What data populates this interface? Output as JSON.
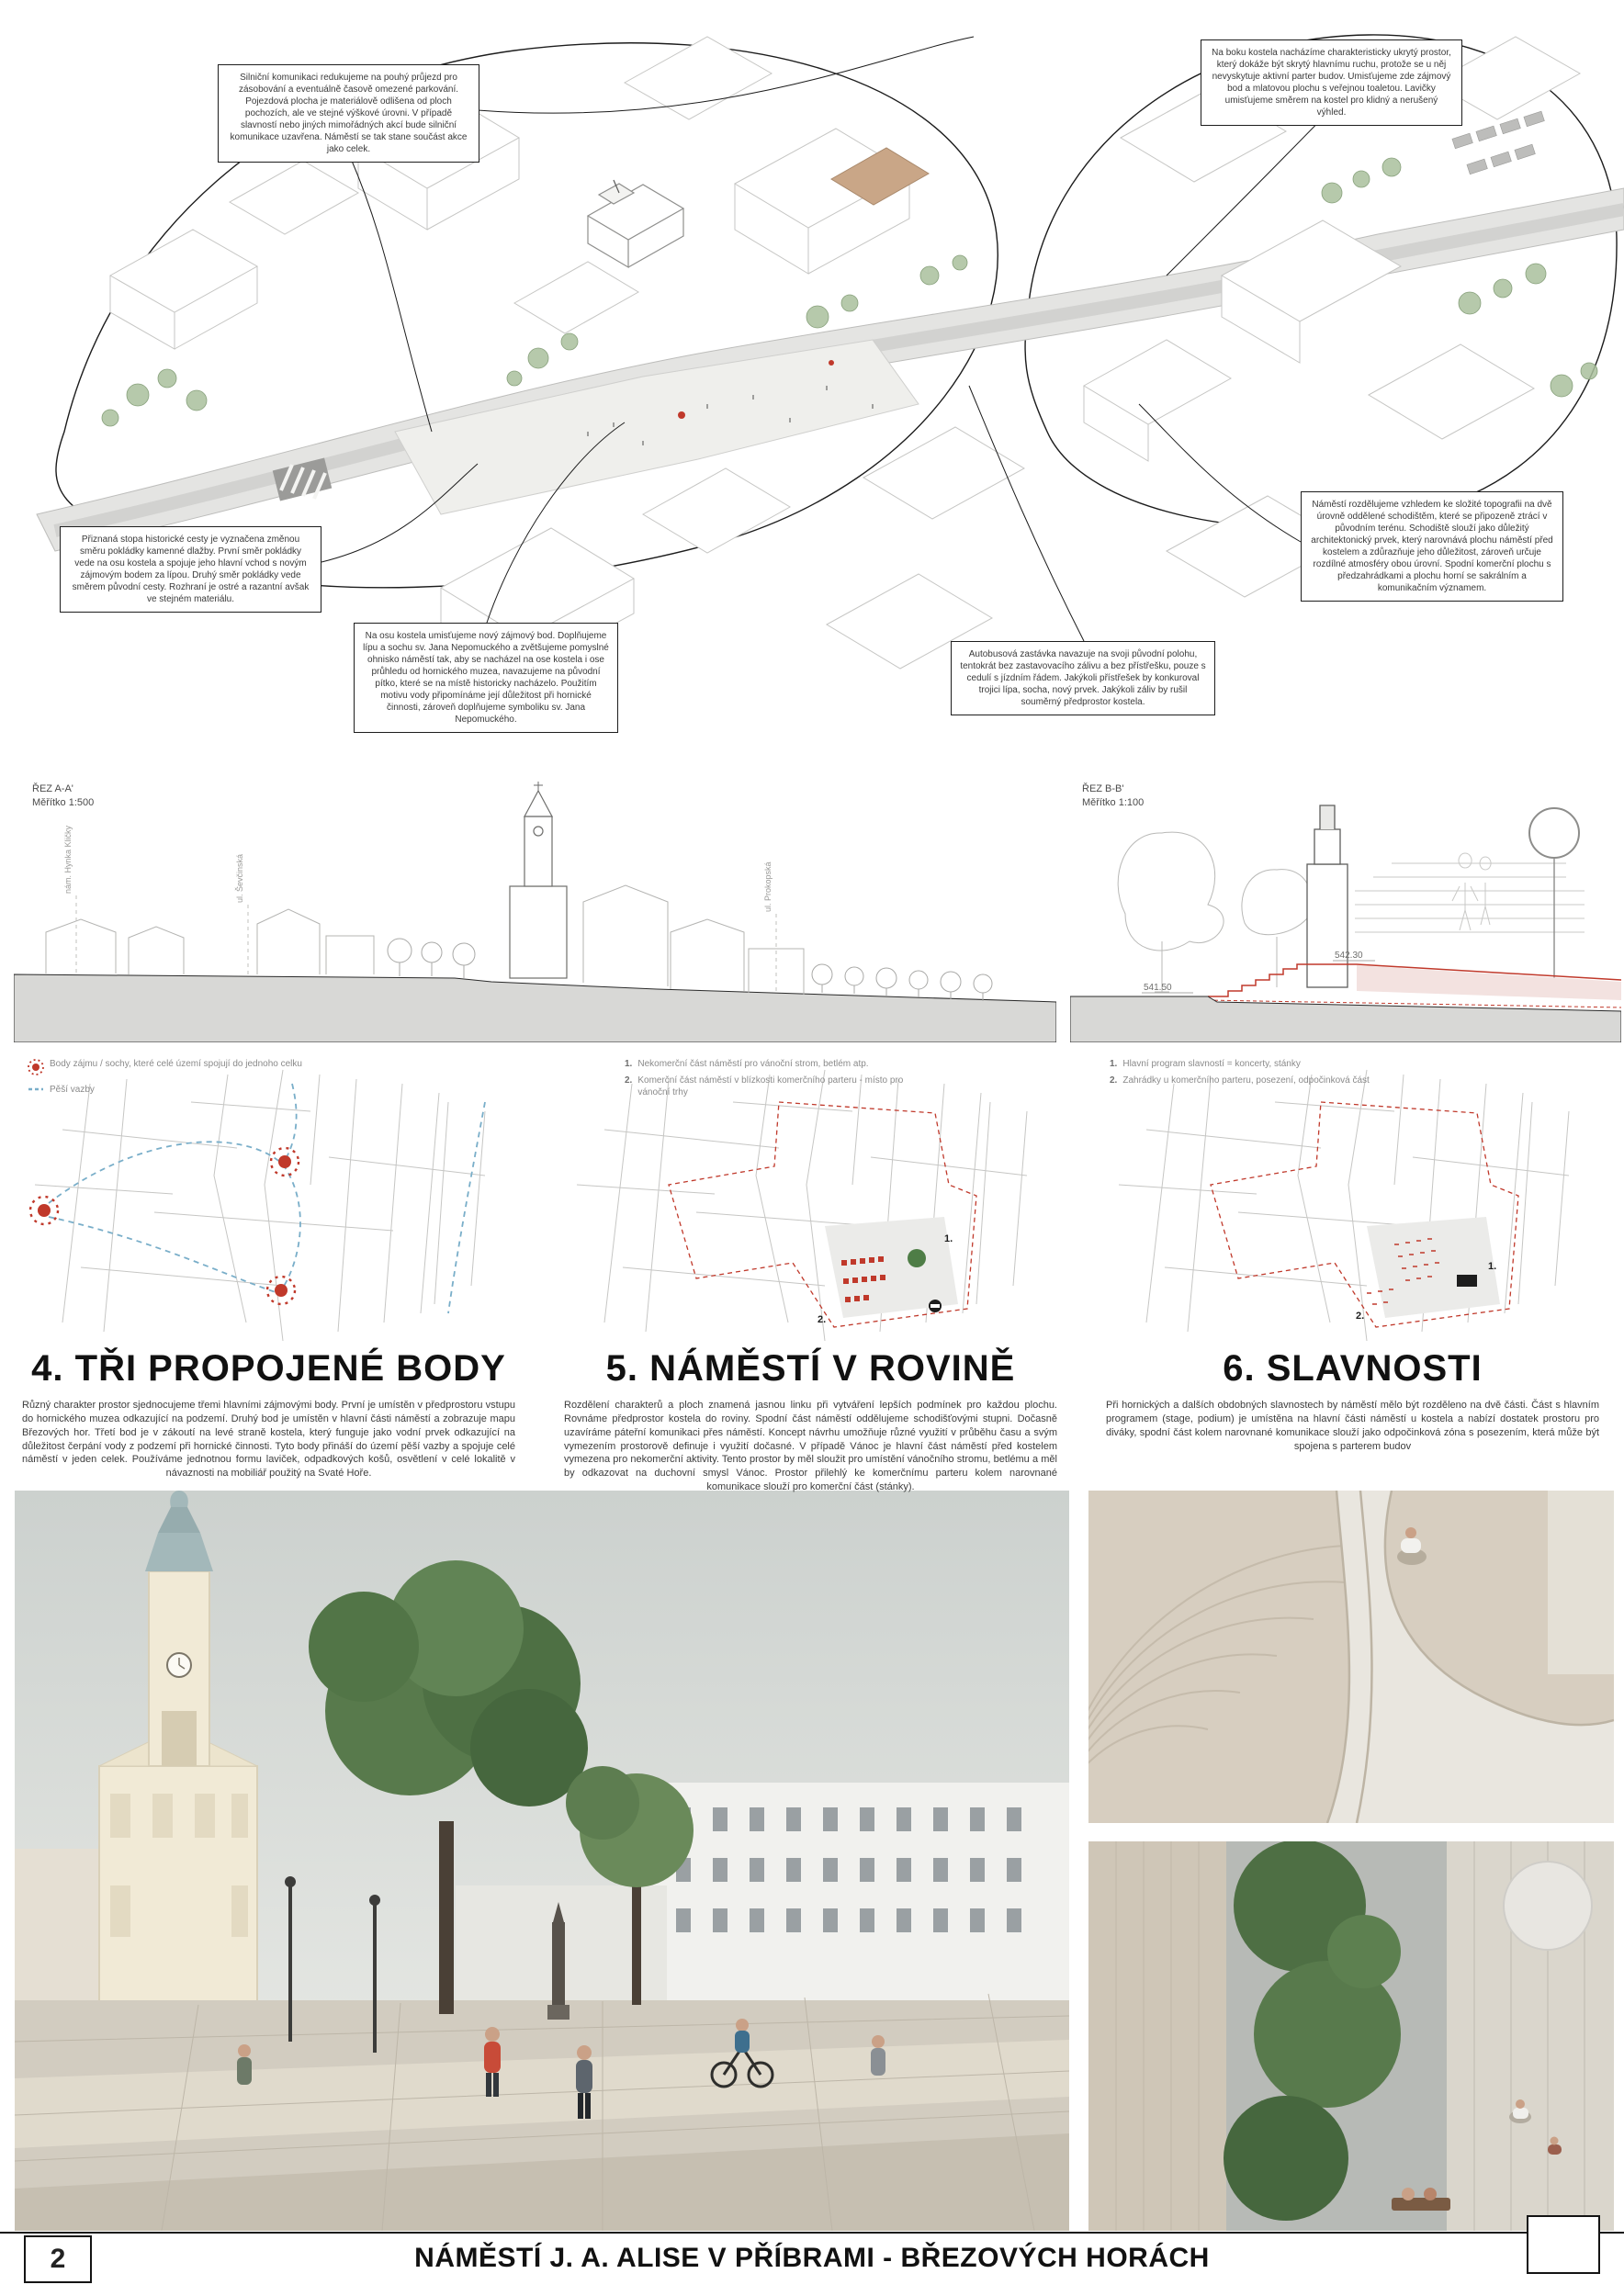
{
  "page": {
    "number": "2",
    "title": "NÁMĚSTÍ J. A. ALISE V PŘÍBRAMI - BŘEZOVÝCH HORÁCH"
  },
  "colors": {
    "accent_red": "#c0392b",
    "path_blue": "#79aec9",
    "tree_green": "#7f9d74",
    "drawing_gray": "#c6c6c4"
  },
  "plan_annotations": {
    "road": "Silniční komunikaci redukujeme na pouhý průjezd pro zásobování a eventuálně časově omezené parkování. Pojezdová plocha je materiálově odlišena od ploch pochozích, ale ve stejné výškové úrovni. V případě slavností nebo jiných mimořádných akcí bude silniční komunikace uzavřena. Náměstí se tak stane součást akce jako celek.",
    "hidden_space": "Na boku kostela nacházíme charakteristicky ukrytý prostor, který dokáže být skrytý hlavnímu ruchu, protože se u něj nevyskytuje aktivní parter budov. Umisťujeme zde zájmový bod a mlatovou plochu s veřejnou toaletou. Lavičky umisťujeme směrem na kostel pro klidný a nerušený výhled.",
    "historic_path": "Přiznaná stopa historické cesty je vyznačena změnou směru pokládky kamenné dlažby. První směr pokládky vede na osu kostela a spojuje jeho hlavní vchod s novým zájmovým bodem za lípou. Druhý směr pokládky vede směrem původní cesty. Rozhraní je ostré a razantní avšak ve stejném materiálu.",
    "axis_point": "Na osu kostela umisťujeme nový zájmový bod. Doplňujeme lípu a sochu sv. Jana Nepomuckého a zvětšujeme pomyslné ohnisko náměstí tak, aby se nacházel na ose kostela i ose průhledu od hornického muzea, navazujeme na původní pítko, které se na místě historicky nacházelo. Použitím motivu vody připomínáme její důležitost při hornické činnosti, zároveň doplňujeme symboliku sv. Jana Nepomuckého.",
    "two_levels": "Náměstí rozdělujeme vzhledem ke složité topografii na dvě úrovně oddělené schodištěm, které se připozeně ztrácí v původním terénu. Schodiště slouží jako důležitý architektonický prvek, který narovnává plochu náměstí před kostelem a zdůrazňuje jeho důležitost, zároveň určuje rozdílné atmosféry obou úrovní. Spodní komerční plochu s předzahrádkami a plochu horní se sakrálním a komunikačním významem.",
    "bus_stop": "Autobusová zastávka navazuje na svoji původní polohu, tentokrát bez zastavovacího zálivu a bez přístřešku, pouze s cedulí s jízdním řádem. Jakýkoli přístřešek by konkuroval trojici lípa, socha, nový prvek. Jakýkoli záliv by rušil souměrný předprostor kostela."
  },
  "sections": {
    "a": {
      "title": "ŘEZ A-A'",
      "scale": "Měřítko 1:500",
      "street_labels": [
        "nám. Hynka Kličky",
        "ul. Ševčinská",
        "ul. Prokopská"
      ]
    },
    "b": {
      "title": "ŘEZ B-B'",
      "scale": "Měřítko 1:100",
      "elevation_upper": "542.30",
      "elevation_lower": "541.50"
    }
  },
  "concepts": [
    {
      "heading": "4. TŘI PROPOJENÉ BODY",
      "body": "Různý charakter prostor sjednocujeme třemi hlavními zájmovými body. První je umístěn v předprostoru vstupu do hornického muzea odkazující na podzemí. Druhý bod je umístěn v hlavní části náměstí a zobrazuje mapu Březových hor. Třetí bod je v zákoutí na levé straně kostela, který funguje jako vodní prvek odkazující na důležitost čerpání vody z podzemí při hornické činnosti. Tyto body přináší do území pěší vazby a spojuje celé náměstí v jeden celek. Používáme jednotnou formu laviček, odpadkových košů, osvětlení v celé lokalitě v návaznosti na mobiliář použitý na Svaté Hoře.",
      "legend": [
        {
          "label": "Body zájmu / sochy, které celé území spojují do jednoho celku"
        },
        {
          "label": "Pěší vazby"
        }
      ]
    },
    {
      "heading": "5. NÁMĚSTÍ V ROVINĚ",
      "body": "Rozdělení charakterů a ploch znamená jasnou linku při vytváření lepších podmínek pro každou plochu. Rovnáme předprostor kostela do roviny. Spodní část náměstí oddělujeme schodišťovými stupni. Dočasně uzavíráme páteřní komunikaci přes náměstí. Koncept návrhu umožňuje různé využití v průběhu času a svým vymezením prostorově definuje i využití dočasné. V případě Vánoc je hlavní část náměstí před kostelem vymezena pro nekomerční aktivity. Tento prostor by měl sloužit pro umístění vánočního stromu, betlému a měl by odkazovat na duchovní smysl Vánoc. Prostor přilehlý ke komerčnímu parteru kolem narovnané komunikace slouží pro komerční část (stánky).",
      "legend": [
        {
          "num": "1.",
          "label": "Nekomerční část náměstí pro vánoční strom, betlém atp."
        },
        {
          "num": "2.",
          "label": "Komerční část náměstí v blízkosti komerčního parteru - místo pro vánoční trhy"
        }
      ],
      "markers": [
        "1.",
        "2."
      ]
    },
    {
      "heading": "6. SLAVNOSTI",
      "body": "Při hornických a dalších obdobných slavnostech by náměstí mělo být rozděleno na dvě části. Část s hlavním programem (stage, podium) je umístěna na hlavní části náměstí u kostela a nabízí dostatek prostoru pro diváky, spodní část kolem narovnané komunikace slouží jako odpočinková zóna s posezením, která může být spojena s parterem budov",
      "legend": [
        {
          "num": "1.",
          "label": "Hlavní program slavností = koncerty, stánky"
        },
        {
          "num": "2.",
          "label": "Zahrádky u komerčního parteru, posezení, odpočinková část"
        }
      ],
      "markers": [
        "1.",
        "2."
      ]
    }
  ]
}
